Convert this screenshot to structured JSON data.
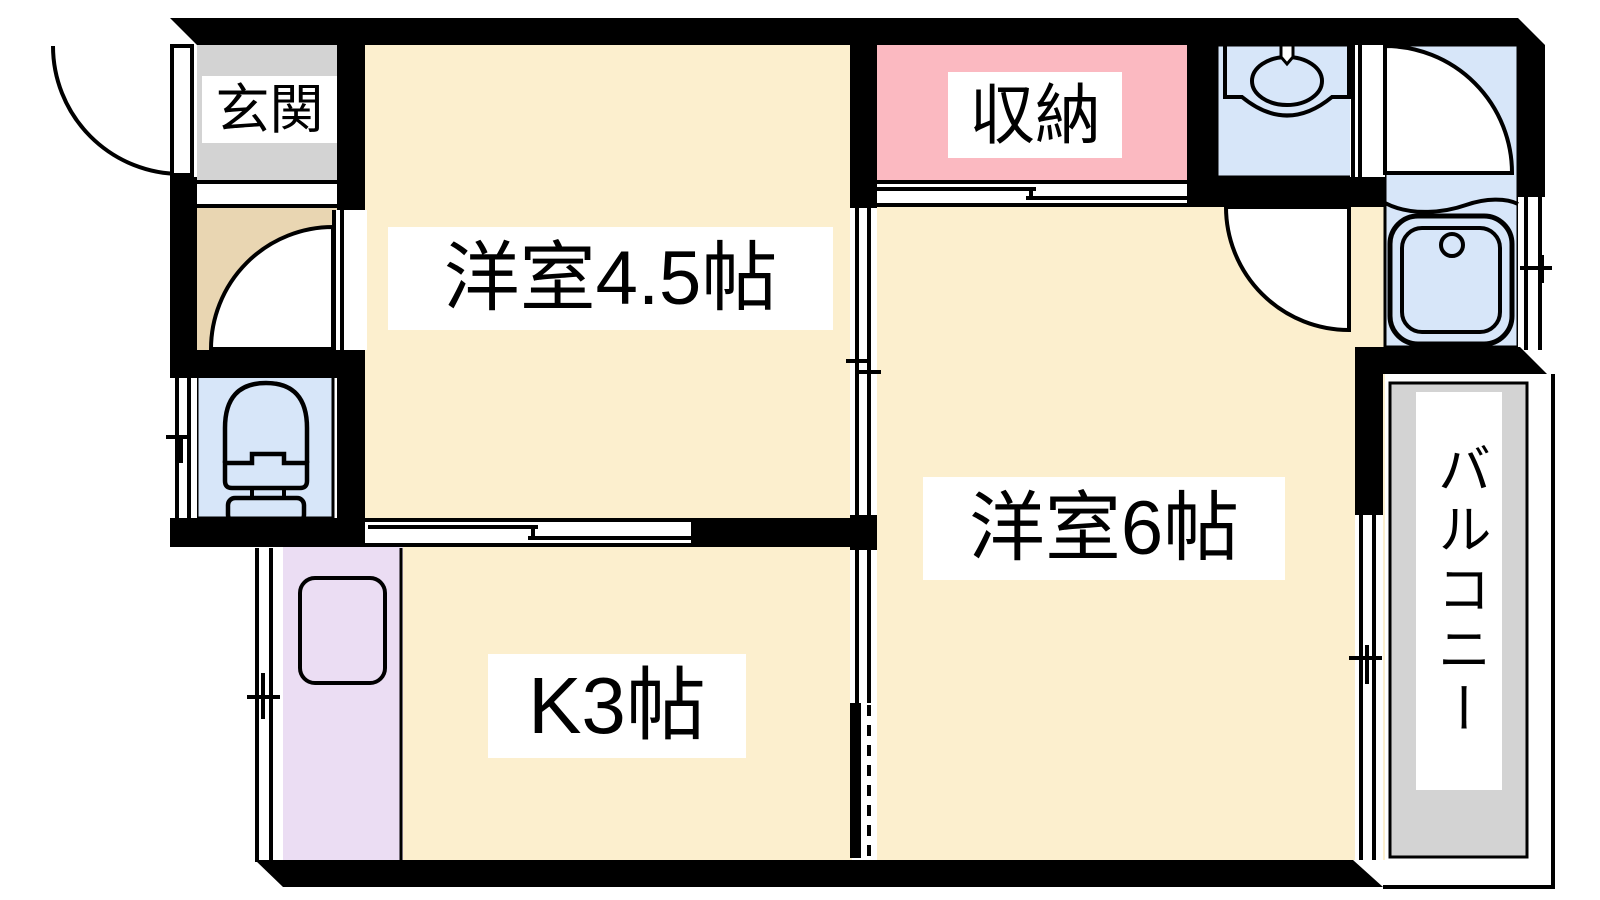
{
  "floorplan": {
    "labels": {
      "entrance": "玄関",
      "western45": "洋室4.5帖",
      "closet": "収納",
      "western6": "洋室6帖",
      "kitchen": "K3帖",
      "balcony": "バルコニー"
    },
    "colors": {
      "background": "#ffffff",
      "wall": "#000000",
      "line": "#000000",
      "room_cream": "#fcefce",
      "hall_tan": "#e9d6b2",
      "closet_pink": "#fbb9c1",
      "water_blue": "#d7e6f9",
      "kitchen_purple": "#ebddf3",
      "gray": "#d3d3d3",
      "label_bg": "#ffffff",
      "label_text": "#000000"
    }
  }
}
